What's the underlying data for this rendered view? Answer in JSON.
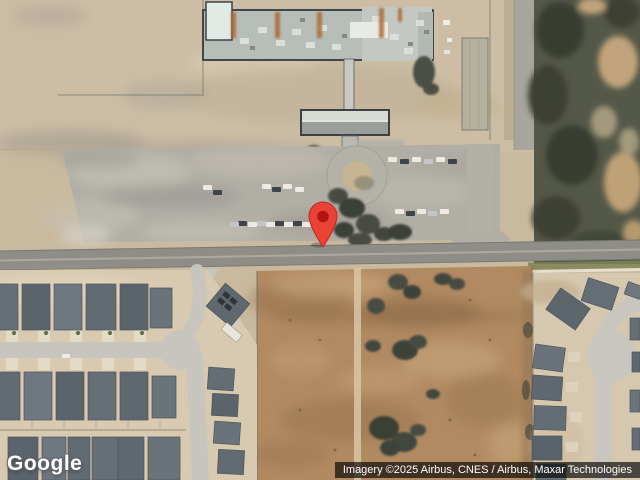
{
  "map": {
    "view_type": "satellite",
    "marker": {
      "name": "location-pin",
      "tip_x": 323,
      "tip_y": 247
    },
    "scene_summary": "Satellite view of a school campus with long gray-roofed building, drop-off canopy, roundabout and large parking lot above an east-west road; residential subdivisions lower-left and lower-right; open brown field in lower center; tree stands on the right"
  },
  "branding": {
    "logo_text": "Google"
  },
  "attribution": {
    "text": "Imagery ©2025 Airbus, CNES / Airbus, Maxar Technologies"
  },
  "palette": {
    "dirt": "#c9b99e",
    "parking": "#b1aea6",
    "road": "#8e8d88",
    "field": "#b18a62",
    "trees": "#545848",
    "house_roof": "#636b73",
    "school_roof": "#b7bdb7",
    "marker_body": "#EA4335",
    "marker_stroke": "#C5221F",
    "marker_dot": "#B31412",
    "attribution_bg": "rgba(0,0,0,0.65)",
    "attribution_text": "#ffffff",
    "logo_color": "#ffffff"
  }
}
